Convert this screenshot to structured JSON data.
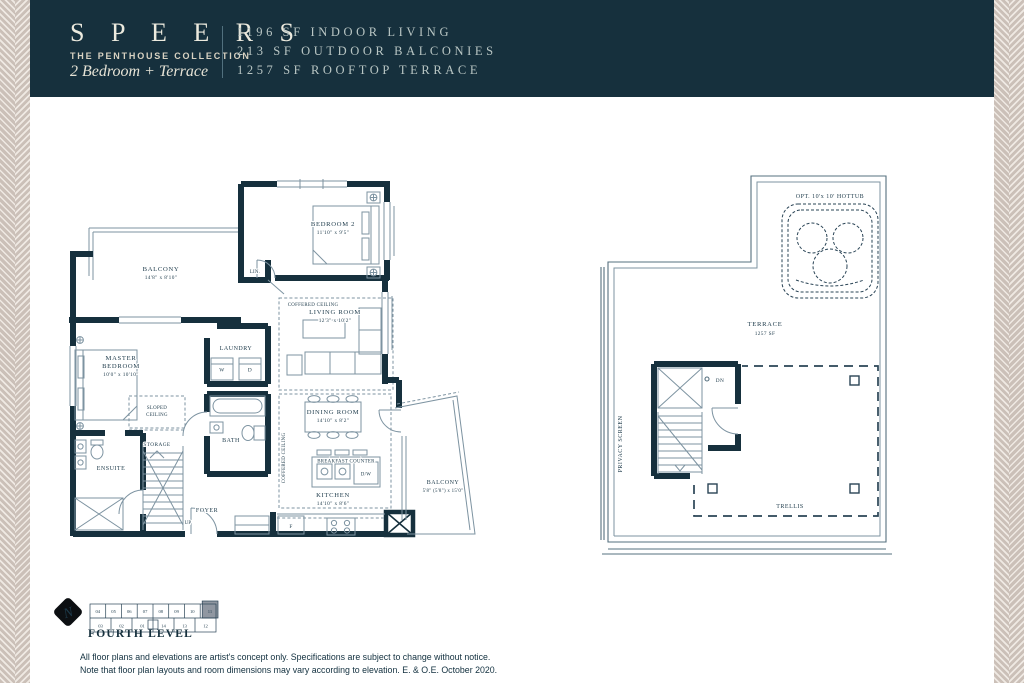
{
  "colors": {
    "navy": "#16303d",
    "line": "#7d93a1",
    "pattern": "#cbc0b8",
    "ivory": "#eceade"
  },
  "header": {
    "brand": "S P E E R S",
    "collection": "THE PENTHOUSE COLLECTION",
    "unit_type": "2 Bedroom + Terrace",
    "stats": [
      "1196 SF INDOOR LIVING",
      "213 SF OUTDOOR BALCONIES",
      "1257 SF ROOFTOP TERRACE"
    ]
  },
  "plan_left": {
    "bedroom2": {
      "name": "BEDROOM 2",
      "dims": "11'10\" x 9'5\""
    },
    "balcony_top": {
      "name": "BALCONY",
      "dims": "14'8\" x 8'10\""
    },
    "linen": "LIN.",
    "coffered_living": "COFFERED CEILING",
    "coffered_kitchen": "COFFERED CEILING",
    "living": {
      "name": "LIVING ROOM",
      "dims": "12'3\" x 10'2\""
    },
    "master": {
      "line1": "MASTER",
      "line2": "BEDROOM",
      "dims": "10'0\" x 10'10\""
    },
    "laundry": {
      "name": "LAUNDRY",
      "washer": "W",
      "dryer": "D"
    },
    "sloped": {
      "line1": "SLOPED",
      "line2": "CEILING"
    },
    "storage": "STORAGE",
    "bath": "BATH",
    "ensuite": "ENSUITE",
    "dining": {
      "name": "DINING ROOM",
      "dims": "14'10\" x 8'2\""
    },
    "breakfast": "BREAKFAST COUNTER",
    "dishwasher": "D/W",
    "kitchen": {
      "name": "KITCHEN",
      "dims": "14'10\" x 8'6\""
    },
    "balcony_right": {
      "name": "BALCONY",
      "dims": "5'8\" (5'8\") x 15'0\""
    },
    "foyer": "FOYER",
    "up": "UP",
    "fridge": "F"
  },
  "plan_right": {
    "hottub": "OPT. 10'x 10' HOTTUB",
    "terrace": {
      "name": "TERRACE",
      "area": "1257 SF"
    },
    "privacy_screen": "PRIVACY SCREEN",
    "dn": "DN",
    "trellis": "TRELLIS"
  },
  "key_plan": {
    "north": "N",
    "level": "FOURTH LEVEL",
    "highlighted_unit": "11",
    "units_top": [
      "04",
      "05",
      "06",
      "07",
      "08",
      "09",
      "10",
      "11"
    ],
    "units_bottom": [
      "03",
      "02",
      "01",
      "14",
      "13",
      "12"
    ]
  },
  "footer": {
    "line1": "All floor plans and elevations are artist's concept only. Specifications are subject to change without notice.",
    "line2": "Note that floor plan layouts and room dimensions may vary according to elevation. E. & O.E. October 2020."
  }
}
